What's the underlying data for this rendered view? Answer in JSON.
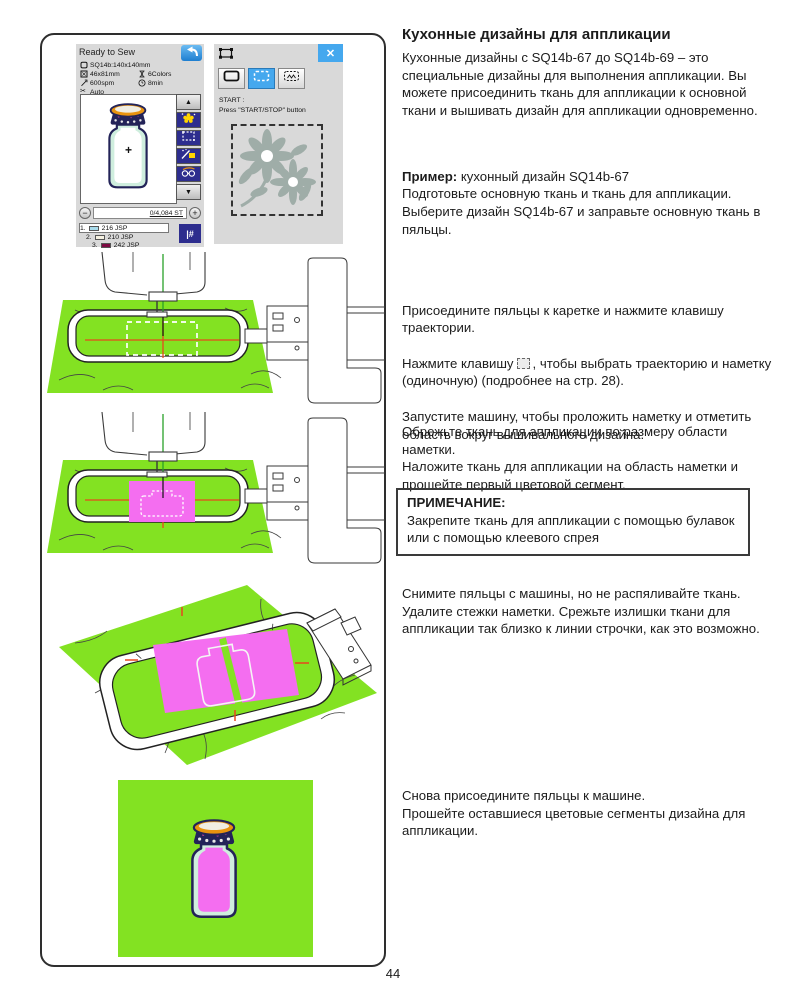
{
  "colors": {
    "green": "#83e222",
    "pink": "#f46ef0",
    "red_line": "#e8481c",
    "navy": "#2d2d8e",
    "lcd_bg": "#d9d9d9",
    "accent_blue": "#45a8ee",
    "flower_gray": "#9fada8",
    "thread_green": "#2aa02a"
  },
  "lcd1": {
    "title": "Ready to Sew",
    "info": [
      {
        "icon": "hoop-icon",
        "label": "SQ14b:140x140mm"
      },
      {
        "icon": "design-size-icon",
        "label": "46x81mm"
      },
      {
        "icon": "spool-icon",
        "label": "6Colors"
      },
      {
        "icon": "speed-icon",
        "label": "600spm"
      },
      {
        "icon": "clock-icon",
        "label": "8min"
      },
      {
        "icon": "scissors-icon",
        "label": "Auto"
      }
    ],
    "scroll_up": "▲",
    "scroll_down": "▼",
    "minus": "−",
    "plus": "+",
    "counter": "0/4,084 ST",
    "threads": [
      {
        "num": "1.",
        "code": "216 JSP",
        "color": "#a9dcec"
      },
      {
        "num": "2.",
        "code": "210 JSP",
        "color": "#f5f1e1"
      },
      {
        "num": "3.",
        "code": "242 JSP",
        "color": "#7c0a42"
      }
    ],
    "thread_number_button": "|#"
  },
  "lcd2": {
    "close_label": "✕",
    "start_text": "START :\nPress \"START/STOP\" button"
  },
  "article": {
    "title": "Кухонные дизайны для аппликации",
    "intro": "Кухонные дизайны с SQ14b-67 до SQ14b-69 – это специальные дизайны для выполнения аппликации. Вы можете присоединить ткань для аппликации к основной ткани и вышивать дизайн для аппликации одновременно.",
    "example_label": "Пример:",
    "example_rest": " кухонный дизайн SQ14b-67",
    "example_body": "Подготовьте основную ткань и ткань для аппликации.\nВыберите дизайн SQ14b-67 и заправьте основную ткань в пяльцы.",
    "step_attach_1": "Присоедините пяльцы к каретке и нажмите клавишу траектории.",
    "step_attach_2a": "Нажмите клавишу",
    "step_attach_2b": ", чтобы выбрать траекторию и наметку (одиночную) (подробнее на стр. 28).",
    "step_attach_3": "Запустите машину, чтобы проложить наметку и отметить область вокруг вышивального дизайна.",
    "step_cut": "Обрежьте ткань для аппликации по размеру области наметки.\nНаложите ткань для аппликации на область наметки и прошейте первый цветовой сегмент.",
    "note_title": "ПРИМЕЧАНИЕ:",
    "note_body": "Закрепите ткань для аппликации с помощью булавок или с помощью клеевого спрея",
    "step_remove": "Снимите пяльцы с машины, но не распяливайте ткань.\nУдалите стежки наметки. Срежьте излишки ткани для аппликации так близко к линии строчки, как это возможно.",
    "step_finish": "Снова присоедините пяльцы к машине.\nПрошейте оставшиеся цветовые сегменты дизайна для аппликации."
  },
  "page_number": "44"
}
